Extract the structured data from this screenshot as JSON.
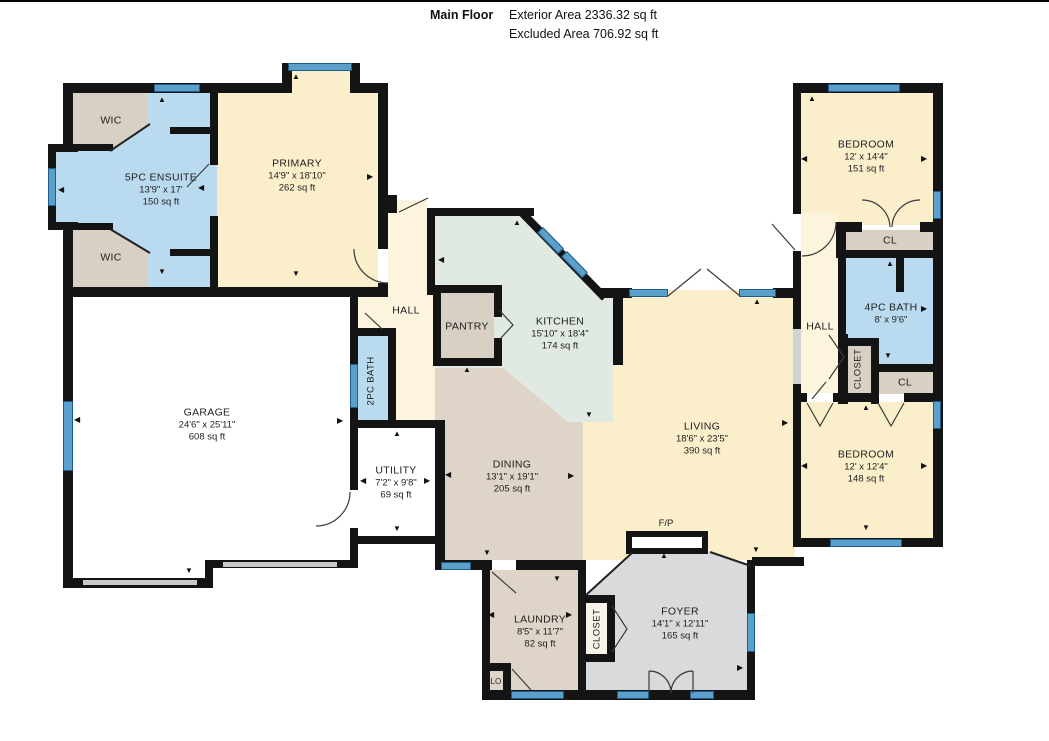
{
  "header": {
    "title": "Main Floor",
    "exterior": "Exterior Area 2336.32 sq ft",
    "excluded": "Excluded Area 706.92 sq ft"
  },
  "rooms": {
    "primary": {
      "name": "PRIMARY",
      "dims": "14'9\" x 18'10\"",
      "area": "262 sq ft"
    },
    "ensuite": {
      "name": "5PC ENSUITE",
      "dims": "13'9\" x 17'",
      "area": "150 sq ft"
    },
    "wic_top": {
      "name": "WIC"
    },
    "wic_bottom": {
      "name": "WIC"
    },
    "garage": {
      "name": "GARAGE",
      "dims": "24'6\" x 25'11\"",
      "area": "608 sq ft"
    },
    "hall_left": {
      "name": "HALL"
    },
    "bath_2pc": {
      "name": "2PC BATH"
    },
    "pantry": {
      "name": "PANTRY"
    },
    "kitchen": {
      "name": "KITCHEN",
      "dims": "15'10\" x 18'4\"",
      "area": "174 sq ft"
    },
    "utility": {
      "name": "UTILITY",
      "dims": "7'2\" x 9'8\"",
      "area": "69 sq ft"
    },
    "dining": {
      "name": "DINING",
      "dims": "13'1\" x 19'1\"",
      "area": "205 sq ft"
    },
    "living": {
      "name": "LIVING",
      "dims": "18'6\" x 23'5\"",
      "area": "390 sq ft"
    },
    "fireplace": {
      "name": "F/P"
    },
    "bedroom_top": {
      "name": "BEDROOM",
      "dims": "12' x 14'4\"",
      "area": "151 sq ft"
    },
    "cl_top": {
      "name": "CL"
    },
    "bath_4pc": {
      "name": "4PC BATH",
      "dims": "8' x 9'6\""
    },
    "hall_right": {
      "name": "HALL"
    },
    "closet_right": {
      "name": "CLOSET"
    },
    "cl_bottom": {
      "name": "CL"
    },
    "bedroom_bottom": {
      "name": "BEDROOM",
      "dims": "12' x 12'4\"",
      "area": "148 sq ft"
    },
    "laundry": {
      "name": "LAUNDRY",
      "dims": "8'5\" x 11'7\"",
      "area": "82 sq ft"
    },
    "closet_bottom": {
      "name": "CLOSET"
    },
    "foyer": {
      "name": "FOYER",
      "dims": "14'1\" x 12'11\"",
      "area": "165 sq ft"
    },
    "clo": {
      "name": "CLO"
    }
  },
  "colors": {
    "wall": "#141414",
    "window_fill": "#5b9fcb",
    "window_edge": "#1f5c8b",
    "room_cream": "#faeecb",
    "room_hall_cream": "#fcf4dc",
    "room_blue": "#badaf0",
    "room_tan": "#d9d0c4",
    "room_tan_dining": "#ded5c8",
    "room_mint": "#e0eae3",
    "room_gray": "#d9dadb",
    "room_white": "#ffffff"
  }
}
